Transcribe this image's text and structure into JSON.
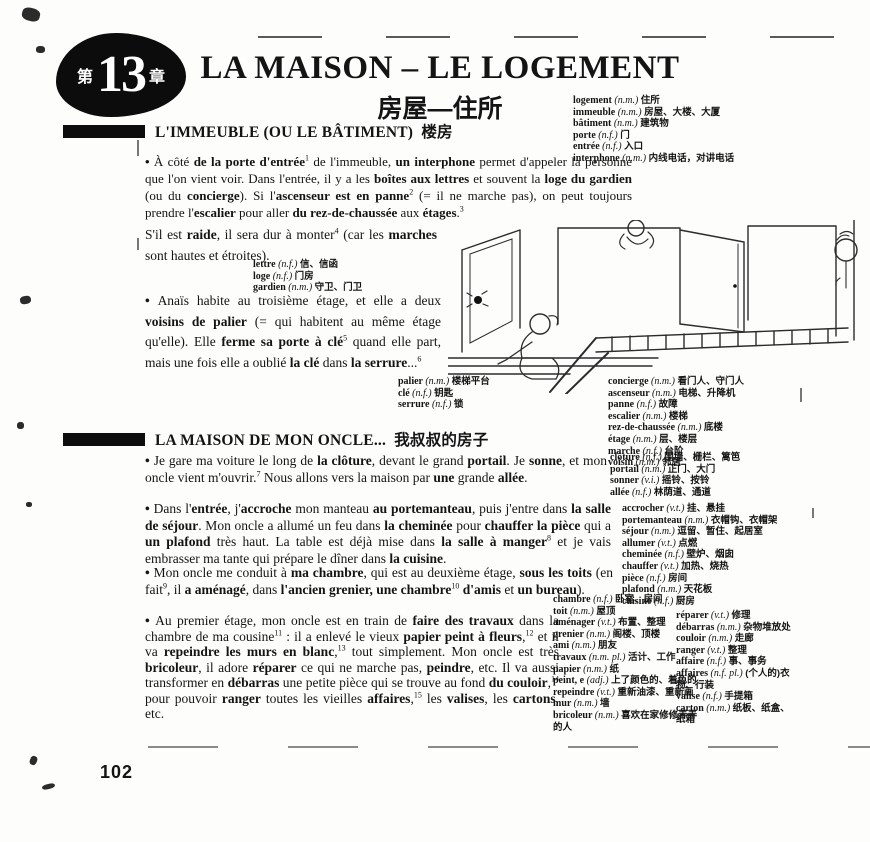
{
  "badge": {
    "prefix": "第",
    "number": "13",
    "suffix": "章"
  },
  "header": {
    "title": "LA MAISON – LE LOGEMENT",
    "subtitle": "房屋—住所"
  },
  "sections": [
    {
      "heading": "L'IMMEUBLE (OU LE BÂTIMENT)",
      "heading_cn": "楼房"
    },
    {
      "heading": "LA MAISON DE MON ONCLE...",
      "heading_cn": "我叔叔的房子"
    }
  ],
  "page": {
    "number": "102"
  },
  "illustration": {
    "description": "line drawing of a landing with open doors, a person kneeling at a keyhole, a staircase with railing and a neighbour peeking from a door"
  },
  "paragraphs": {
    "p1a": {
      "segments": [
        {
          "t": "•  ",
          "b": true
        },
        {
          "t": "À côté "
        },
        {
          "t": "de la porte d'entrée",
          "b": true
        },
        {
          "s": "1"
        },
        {
          "t": " de l'immeuble, "
        },
        {
          "t": "un interphone",
          "b": true
        },
        {
          "t": " permet d'appeler la personne que l'on vient voir. Dans l'entrée, il y a les "
        },
        {
          "t": "boîtes aux lettres",
          "b": true
        },
        {
          "t": " et souvent la "
        },
        {
          "t": "loge du gardien",
          "b": true
        },
        {
          "t": " (ou du "
        },
        {
          "t": "concierge",
          "b": true
        },
        {
          "t": "). Si l'"
        },
        {
          "t": "ascenseur est en panne",
          "b": true
        },
        {
          "s": "2"
        },
        {
          "t": " (= il ne marche pas), on peut toujours prendre l'"
        },
        {
          "t": "escalier",
          "b": true
        },
        {
          "t": " pour aller "
        },
        {
          "t": "du rez-de-chaussée",
          "b": true
        },
        {
          "t": " aux "
        },
        {
          "t": "étages",
          "b": true
        },
        {
          "t": "."
        },
        {
          "s": "3"
        }
      ]
    },
    "p1b": {
      "segments": [
        {
          "t": "S'il est "
        },
        {
          "t": "raide",
          "b": true
        },
        {
          "t": ", il sera dur à monter"
        },
        {
          "s": "4"
        },
        {
          "t": " (car les "
        },
        {
          "t": "marches",
          "b": true
        },
        {
          "t": " sont hautes et étroites)."
        }
      ]
    },
    "p2": {
      "segments": [
        {
          "t": "•  ",
          "b": true
        },
        {
          "t": "Anaïs habite au troisième étage, et elle a deux "
        },
        {
          "t": "voisins de palier",
          "b": true
        },
        {
          "t": " (= qui habitent au même étage qu'elle). Elle "
        },
        {
          "t": "ferme sa porte à clé",
          "b": true
        },
        {
          "s": "5"
        },
        {
          "t": " quand elle part, mais une fois elle a oublié "
        },
        {
          "t": "la clé",
          "b": true
        },
        {
          "t": " dans "
        },
        {
          "t": "la serrure",
          "b": true
        },
        {
          "t": "..."
        },
        {
          "s": "6"
        }
      ]
    },
    "p3": {
      "segments": [
        {
          "t": "•  ",
          "b": true
        },
        {
          "t": "Je gare ma voiture le long de "
        },
        {
          "t": "la clôture",
          "b": true
        },
        {
          "t": ", devant le grand "
        },
        {
          "t": "portail",
          "b": true
        },
        {
          "t": ". Je "
        },
        {
          "t": "sonne",
          "b": true
        },
        {
          "t": ", et mon oncle vient m'ouvrir."
        },
        {
          "s": "7"
        },
        {
          "t": " Nous allons vers la maison par "
        },
        {
          "t": "une",
          "b": true
        },
        {
          "t": " grande "
        },
        {
          "t": "allée",
          "b": true
        },
        {
          "t": "."
        }
      ]
    },
    "p4": {
      "segments": [
        {
          "t": "•  ",
          "b": true
        },
        {
          "t": "Dans l'"
        },
        {
          "t": "entrée",
          "b": true
        },
        {
          "t": ", j'"
        },
        {
          "t": "accroche",
          "b": true
        },
        {
          "t": " mon manteau "
        },
        {
          "t": "au portemanteau",
          "b": true
        },
        {
          "t": ", puis j'entre dans "
        },
        {
          "t": "la salle de séjour",
          "b": true
        },
        {
          "t": ". Mon oncle a allumé un feu dans "
        },
        {
          "t": "la cheminée",
          "b": true
        },
        {
          "t": " pour "
        },
        {
          "t": "chauffer la pièce",
          "b": true
        },
        {
          "t": " qui a "
        },
        {
          "t": "un plafond",
          "b": true
        },
        {
          "t": " très haut. La table est déjà mise dans "
        },
        {
          "t": "la salle à manger",
          "b": true
        },
        {
          "s": "8"
        },
        {
          "t": " et je vais embrasser ma tante qui prépare le dîner dans "
        },
        {
          "t": "la cuisine",
          "b": true
        },
        {
          "t": "."
        }
      ]
    },
    "p5": {
      "segments": [
        {
          "t": "•  ",
          "b": true
        },
        {
          "t": "Mon oncle me conduit à "
        },
        {
          "t": "ma chambre",
          "b": true
        },
        {
          "t": ", qui est au deuxième étage, "
        },
        {
          "t": "sous les toits",
          "b": true
        },
        {
          "t": " (en fait"
        },
        {
          "s": "9"
        },
        {
          "t": ", il "
        },
        {
          "t": "a aménagé",
          "b": true
        },
        {
          "t": ", dans "
        },
        {
          "t": "l'ancien grenier, une chambre",
          "b": true
        },
        {
          "s": "10"
        },
        {
          "t": " "
        },
        {
          "t": "d'amis",
          "b": true
        },
        {
          "t": " et "
        },
        {
          "t": "un bureau",
          "b": true
        },
        {
          "t": ")."
        }
      ]
    },
    "p6": {
      "segments": [
        {
          "t": "•  ",
          "b": true
        },
        {
          "t": "Au premier étage, mon oncle est en train de "
        },
        {
          "t": "faire des travaux",
          "b": true
        },
        {
          "t": " dans la chambre de ma cousine"
        },
        {
          "s": "11"
        },
        {
          "t": " : il a enlevé le vieux "
        },
        {
          "t": "papier peint à fleurs",
          "b": true
        },
        {
          "t": ","
        },
        {
          "s": "12"
        },
        {
          "t": " et il va "
        },
        {
          "t": "repeindre les murs en blanc",
          "b": true
        },
        {
          "t": ","
        },
        {
          "s": "13"
        },
        {
          "t": " tout simplement. Mon oncle est très "
        },
        {
          "t": "bricoleur",
          "b": true
        },
        {
          "t": ", il adore "
        },
        {
          "t": "réparer",
          "b": true
        },
        {
          "t": " ce qui ne marche pas, "
        },
        {
          "t": "peindre",
          "b": true
        },
        {
          "t": ", etc. Il va aussi transformer en "
        },
        {
          "t": "débarras",
          "b": true
        },
        {
          "t": " une petite pièce qui se trouve au fond "
        },
        {
          "t": "du couloir",
          "b": true
        },
        {
          "t": ","
        },
        {
          "s": "14"
        },
        {
          "t": " pour pouvoir "
        },
        {
          "t": "ranger",
          "b": true
        },
        {
          "t": " toutes les vieilles "
        },
        {
          "t": "affaires",
          "b": true
        },
        {
          "t": ","
        },
        {
          "s": "15"
        },
        {
          "t": " les "
        },
        {
          "t": "valises",
          "b": true
        },
        {
          "t": ", les "
        },
        {
          "t": "cartons",
          "b": true
        },
        {
          "t": ", etc."
        }
      ]
    }
  },
  "vocab": {
    "top": [
      {
        "w": "logement",
        "g": "(n.m.)",
        "c": "住所"
      },
      {
        "w": "immeuble",
        "g": "(n.m.)",
        "c": "房屋、大楼、大厦"
      },
      {
        "w": "bâtiment",
        "g": "(n.m.)",
        "c": "建筑物"
      },
      {
        "w": "porte",
        "g": "(n.f.)",
        "c": "门"
      },
      {
        "w": "entrée",
        "g": "(n.f.)",
        "c": "入口"
      },
      {
        "w": "interphone",
        "g": "(n.m.)",
        "c": "内线电话，对讲电话"
      }
    ],
    "lettre": [
      {
        "w": "lettre",
        "g": "(n.f.)",
        "c": "信、信函"
      },
      {
        "w": "loge",
        "g": "(n.f.)",
        "c": "门房"
      },
      {
        "w": "gardien",
        "g": "(n.m.)",
        "c": "守卫、门卫"
      }
    ],
    "palier": [
      {
        "w": "palier",
        "g": "(n.m.)",
        "c": "楼梯平台"
      },
      {
        "w": "clé",
        "g": "(n.f.)",
        "c": "钥匙"
      },
      {
        "w": "serrure",
        "g": "(n.f.)",
        "c": "锁"
      }
    ],
    "concierge": [
      {
        "w": "concierge",
        "g": "(n.m.)",
        "c": "看门人、守门人"
      },
      {
        "w": "ascenseur",
        "g": "(n.m.)",
        "c": "电梯、升降机"
      },
      {
        "w": "panne",
        "g": "(n.f.)",
        "c": "故障"
      },
      {
        "w": "escalier",
        "g": "(n.m.)",
        "c": "楼梯"
      },
      {
        "w": "rez-de-chaussée",
        "g": "(n.m.)",
        "c": "底楼"
      },
      {
        "w": "étage",
        "g": "(n.m.)",
        "c": "层、楼层"
      },
      {
        "w": "marche",
        "g": "(n.f.)",
        "c": "台阶"
      },
      {
        "w": "voisin",
        "g": "(n.m.)",
        "c": "邻居"
      }
    ],
    "cloture": [
      {
        "w": "clôture",
        "g": "(n.f.)",
        "c": "围墙、栅栏、篱笆"
      },
      {
        "w": "portail",
        "g": "(n.m.)",
        "c": "正门、大门"
      },
      {
        "w": "sonner",
        "g": "(v.i.)",
        "c": "摇铃、按铃"
      },
      {
        "w": "allée",
        "g": "(n.f.)",
        "c": "林荫道、通道"
      }
    ],
    "accrocher": [
      {
        "w": "accrocher",
        "g": "(v.t.)",
        "c": "挂、悬挂"
      },
      {
        "w": "portemanteau",
        "g": "(n.m.)",
        "c": "衣帽钩、衣帽架"
      },
      {
        "w": "séjour",
        "g": "(n.m.)",
        "c": "逗留、暂住、起居室"
      },
      {
        "w": "allumer",
        "g": "(v.t.)",
        "c": "点燃"
      },
      {
        "w": "cheminée",
        "g": "(n.f.)",
        "c": "壁炉、烟囱"
      },
      {
        "w": "chauffer",
        "g": "(v.t.)",
        "c": "加热、烧热"
      },
      {
        "w": "pièce",
        "g": "(n.f.)",
        "c": "房间"
      },
      {
        "w": "plafond",
        "g": "(n.m.)",
        "c": "天花板"
      },
      {
        "w": "cuisine",
        "g": "(n.f.)",
        "c": "厨房"
      }
    ],
    "chambre": [
      {
        "w": "chambre",
        "g": "(n.f.)",
        "c": "卧室、房间"
      },
      {
        "w": "toit",
        "g": "(n.m.)",
        "c": "屋顶"
      },
      {
        "w": "aménager",
        "g": "(v.t.)",
        "c": "布置、整理"
      },
      {
        "w": "grenier",
        "g": "(n.m.)",
        "c": "阁楼、顶楼"
      },
      {
        "w": "ami",
        "g": "(n.m.)",
        "c": "朋友"
      }
    ],
    "travaux": [
      {
        "w": "travaux",
        "g": "(n.m. pl.)",
        "c": "活计、工作"
      },
      {
        "w": "papier",
        "g": "(n.m.)",
        "c": "纸"
      },
      {
        "w": "peint, e",
        "g": "(adj.)",
        "c": "上了颜色的、着色的"
      },
      {
        "w": "repeindre",
        "g": "(v.t.)",
        "c": "重新油漆、重新画"
      },
      {
        "w": "mur",
        "g": "(n.m.)",
        "c": "墙"
      },
      {
        "w": "bricoleur",
        "g": "(n.m.)",
        "c": "喜欢在家修修弄弄的人"
      }
    ],
    "reparer": [
      {
        "w": "réparer",
        "g": "(v.t.)",
        "c": "修理"
      },
      {
        "w": "débarras",
        "g": "(n.m.)",
        "c": "杂物堆放处"
      },
      {
        "w": "couloir",
        "g": "(n.m.)",
        "c": "走廊"
      },
      {
        "w": "ranger",
        "g": "(v.t.)",
        "c": "整理"
      },
      {
        "w": "affaire",
        "g": "(n.f.)",
        "c": "事、事务"
      },
      {
        "w": "affaires",
        "g": "(n.f. pl.)",
        "c": "(个人的)衣物、行装"
      },
      {
        "w": "valise",
        "g": "(n.f.)",
        "c": "手提箱"
      },
      {
        "w": "carton",
        "g": "(n.m.)",
        "c": "纸板、纸盒、纸箱"
      }
    ]
  }
}
